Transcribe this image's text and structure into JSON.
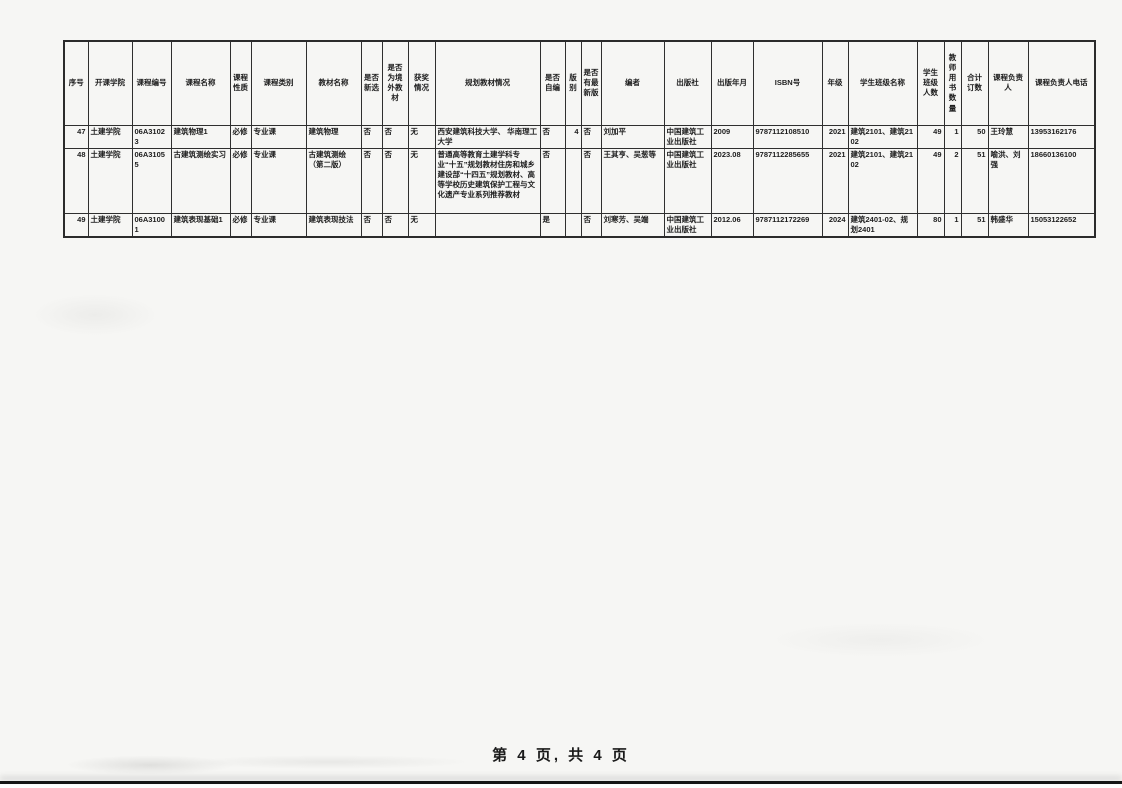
{
  "page": {
    "footer": "第 4 页, 共 4 页"
  },
  "table": {
    "columns": [
      "序号",
      "开课学院",
      "课程编号",
      "课程名称",
      "课程性质",
      "课程类别",
      "教材名称",
      "是否新选",
      "是否为境外教材",
      "获奖情况",
      "规划教材情况",
      "是否自编",
      "版别",
      "是否有最新版",
      "编者",
      "出版社",
      "出版年月",
      "ISBN号",
      "年级",
      "学生班级名称",
      "学生班级人数",
      "教师用书数量",
      "合计订数",
      "课程负责人",
      "课程负责人电话"
    ],
    "rows": [
      [
        "47",
        "土建学院",
        "06A31023",
        "建筑物理1",
        "必修",
        "专业课",
        "建筑物理",
        "否",
        "否",
        "无",
        "西安建筑科技大学、 华南理工大学",
        "否",
        "4",
        "否",
        "刘加平",
        "中国建筑工业出版社",
        "2009",
        "9787112108510",
        "2021",
        "建筑2101、建筑2102",
        "49",
        "1",
        "50",
        "王玲慧",
        "13953162176"
      ],
      [
        "48",
        "土建学院",
        "06A31055",
        "古建筑测绘实习",
        "必修",
        "专业课",
        "古建筑测绘（第二版）",
        "否",
        "否",
        "无",
        "普通高等教育土建学科专业“十五”规划教材住房和城乡建设部“十四五”规划教材、高等学校历史建筑保护工程与文化遗产专业系列推荐教材",
        "否",
        "",
        "否",
        "王其亨、吴葱等",
        "中国建筑工业出版社",
        "2023.08",
        "9787112285655",
        "2021",
        "建筑2101、建筑2102",
        "49",
        "2",
        "51",
        "喻洪、刘强",
        "18660136100"
      ],
      [
        "49",
        "土建学院",
        "06A31001",
        "建筑表现基础1",
        "必修",
        "专业课",
        "建筑表现技法",
        "否",
        "否",
        "无",
        "",
        "是",
        "",
        "否",
        "刘寒芳、吴端",
        "中国建筑工业出版社",
        "2012.06",
        "9787112172269",
        "2024",
        "建筑2401-02、规划2401",
        "80",
        "1",
        "51",
        "韩盛华",
        "15053122652"
      ]
    ]
  }
}
